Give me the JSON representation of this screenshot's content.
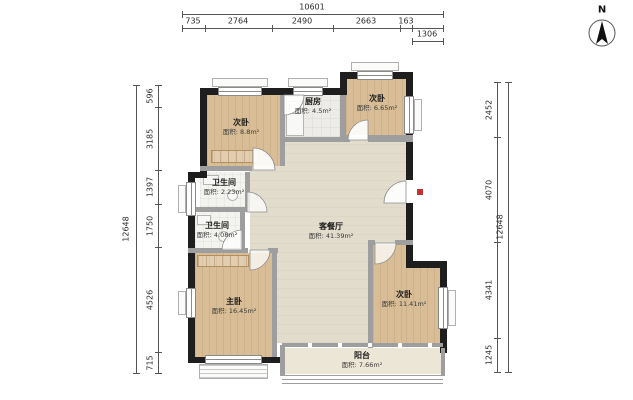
{
  "title": "户型图",
  "compass": {
    "label": "N"
  },
  "rooms": [
    {
      "id": "bedroom-top-left",
      "name": "次卧",
      "area": "面积: 8.8m²"
    },
    {
      "id": "kitchen",
      "name": "厨房",
      "area": "面积: 4.5m²"
    },
    {
      "id": "bedroom-top-right",
      "name": "次卧",
      "area": "面积: 6.65m²"
    },
    {
      "id": "bathroom-1",
      "name": "卫生间",
      "area": "面积: 2.23m²"
    },
    {
      "id": "bathroom-2",
      "name": "卫生间",
      "area": "面积: 4.08m²"
    },
    {
      "id": "living-dining",
      "name": "客餐厅",
      "area": "面积: 41.39m²"
    },
    {
      "id": "master-bedroom",
      "name": "主卧",
      "area": "面积: 16.45m²"
    },
    {
      "id": "bedroom-right",
      "name": "次卧",
      "area": "面积: 11.41m²"
    },
    {
      "id": "balcony",
      "name": "阳台",
      "area": "面积: 7.66m²"
    }
  ],
  "dimensions": {
    "top": {
      "total": "10601",
      "segments": [
        "735",
        "2764",
        "2490",
        "2663",
        "163"
      ],
      "sub": "1306"
    },
    "left": {
      "total": "12648",
      "segments": [
        "596",
        "3185",
        "1397",
        "1750",
        "4526",
        "715"
      ]
    },
    "right": {
      "total": "12648",
      "segments": [
        "2452",
        "4070",
        "4341",
        "1245"
      ]
    }
  },
  "colors": {
    "exterior_wall": "#1e1e1e",
    "interior_wall": "#9e9e9e",
    "wood_floor": "#d8bd96",
    "living_floor": "#e2dccd",
    "tile_floor": "#f3f3f0",
    "balcony_floor": "#ebe6d6",
    "entry_marker": "#c23232"
  }
}
